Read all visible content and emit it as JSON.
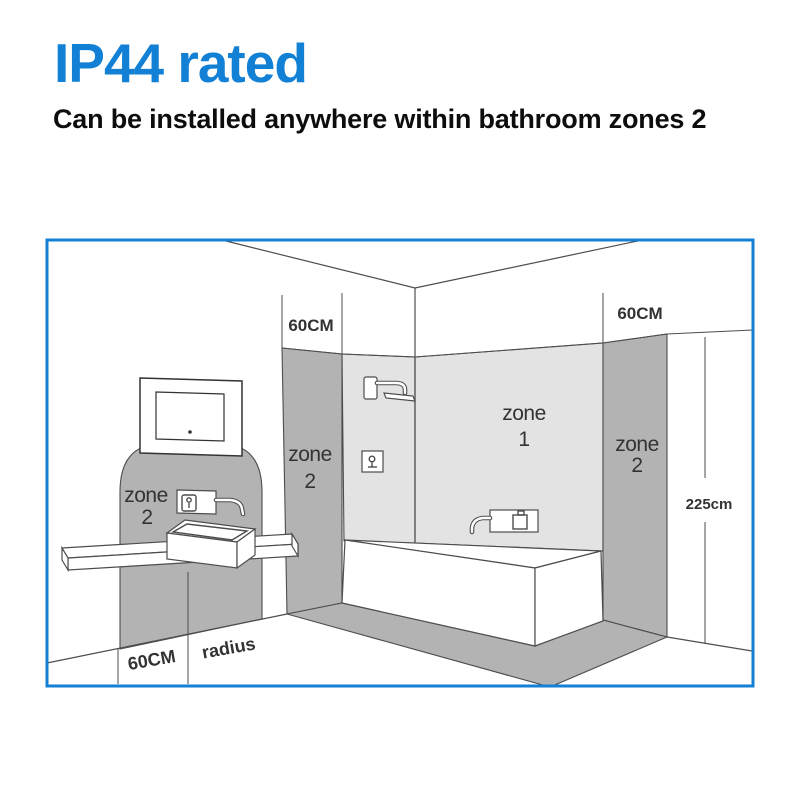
{
  "header": {
    "title": "IP44 rated",
    "subtitle": "Can be installed anywhere within bathroom zones 2"
  },
  "colors": {
    "accent": "#1280d5",
    "zone1_fill": "#e3e3e3",
    "zone2_fill": "#b3b3b3",
    "outline": "#4d4d4d",
    "text": "#333333"
  },
  "diagram": {
    "labels": {
      "top_left_width": "60CM",
      "top_right_width": "60CM",
      "height": "225cm",
      "floor_width": "60CM",
      "floor_radius": "radius",
      "basin_zone_word": "zone",
      "basin_zone_num": "2",
      "shower_zone_word": "zone",
      "shower_zone_num": "2",
      "main_zone_word": "zone",
      "main_zone_num": "1",
      "right_zone_word": "zone",
      "right_zone_num": "2"
    }
  }
}
